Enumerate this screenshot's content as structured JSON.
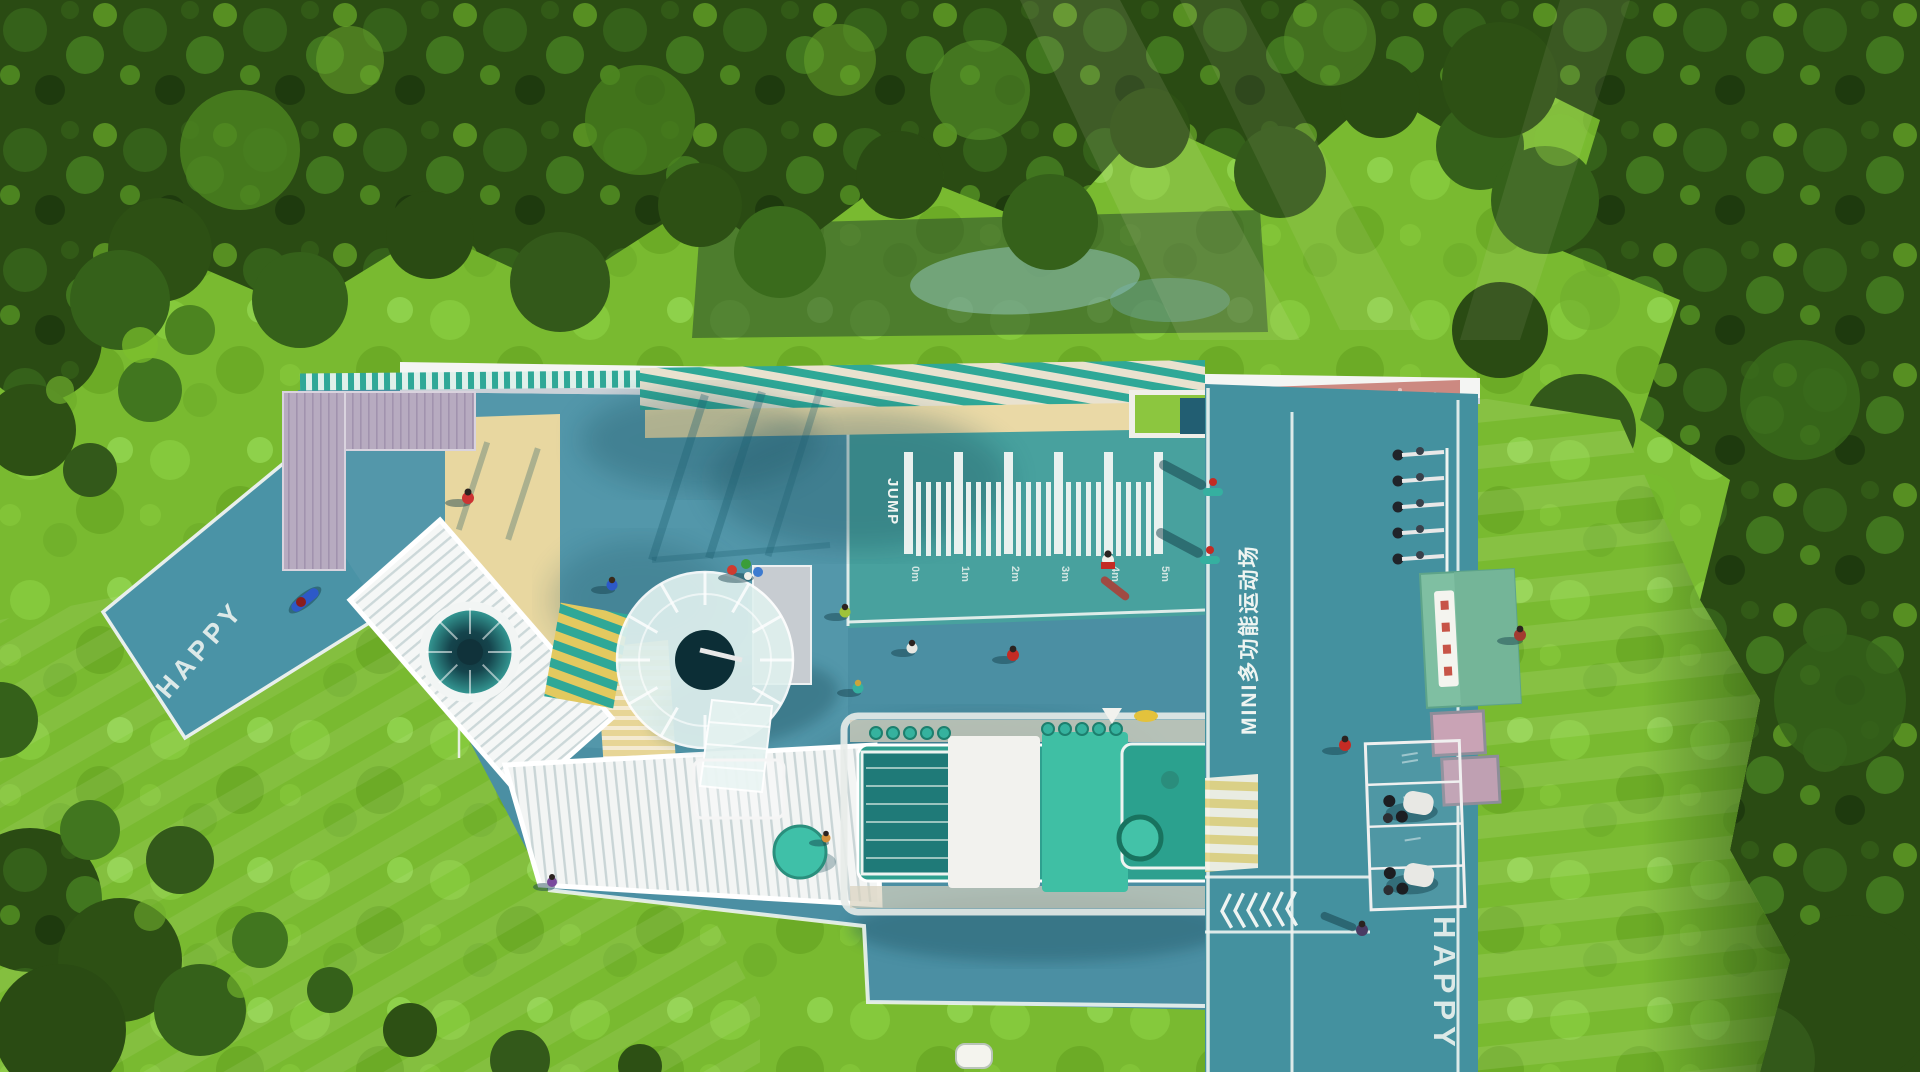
{
  "scene": {
    "description": "Aerial 3D render of a mini multi-purpose children's sports playground surrounded by forest",
    "happy_path_left": "HAPPY",
    "happy_path_right": "HAPPY"
  },
  "jump_ruler": {
    "label": "JUMP",
    "ticks": [
      "0m",
      "1m",
      "2m",
      "3m",
      "4m",
      "5m"
    ]
  },
  "court": {
    "name": "MINI多功能运动场"
  },
  "markings": {
    "chevron_count": 6
  },
  "palette": {
    "grass_bright": "#79ba30",
    "foliage_dark": "#2a4b13",
    "court_blue": "#4b8fa3",
    "sport_teal": "#48a59d",
    "track_teal": "#44919f",
    "sand": "#e8d7a0",
    "wood_deck": "#b7abc0",
    "train_green": "#2ea08f",
    "kiosk_green": "#7fbfa2",
    "pink_mat": "#c9837a",
    "marking_white": "#eef4f2"
  }
}
